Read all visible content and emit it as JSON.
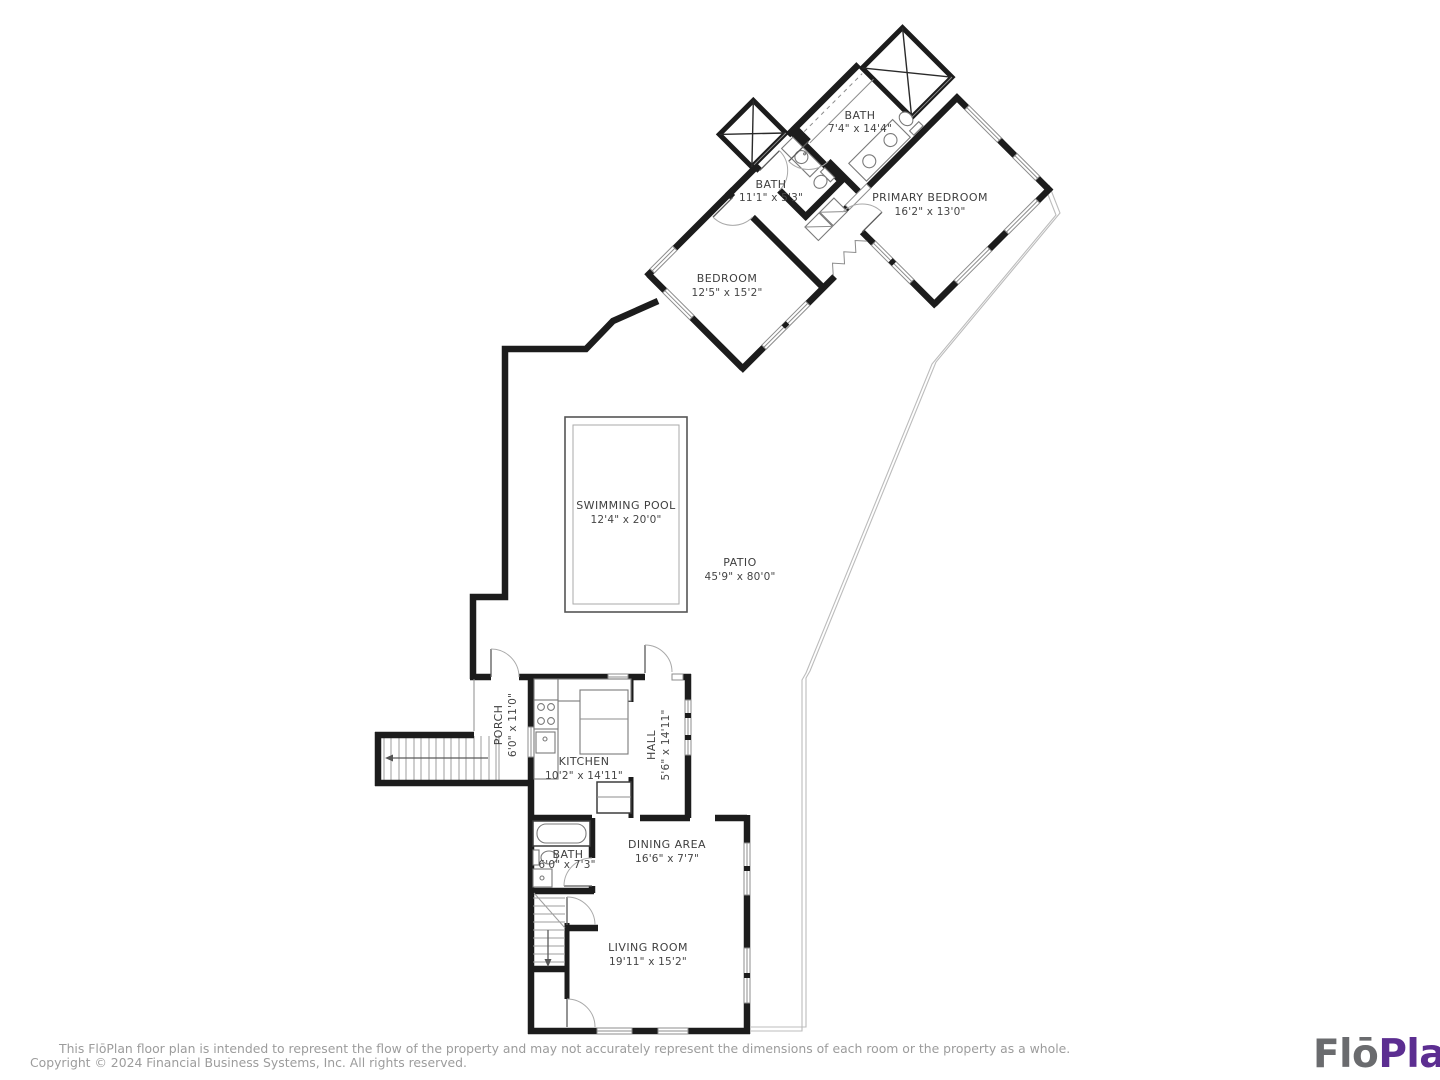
{
  "plan": {
    "rooms": [
      {
        "key": "primary_bedroom",
        "name": "PRIMARY BEDROOM",
        "dims": "16'2\" x 13'0\""
      },
      {
        "key": "bedroom",
        "name": "BEDROOM",
        "dims": "12'5\" x 15'2\""
      },
      {
        "key": "bath_primary",
        "name": "BATH",
        "dims": "7'4\" x 14'4\""
      },
      {
        "key": "bath_upper_hall",
        "name": "BATH",
        "dims": "11'1\" x 5'3\""
      },
      {
        "key": "swimming_pool",
        "name": "SWIMMING POOL",
        "dims": "12'4\" x 20'0\""
      },
      {
        "key": "patio",
        "name": "PATIO",
        "dims": "45'9\" x 80'0\""
      },
      {
        "key": "porch",
        "name": "PORCH",
        "dims": "6'0\" x 11'0\""
      },
      {
        "key": "kitchen",
        "name": "KITCHEN",
        "dims": "10'2\" x 14'11\""
      },
      {
        "key": "hall",
        "name": "HALL",
        "dims": "5'6\" x 14'11\""
      },
      {
        "key": "dining_area",
        "name": "DINING AREA",
        "dims": "16'6\" x 7'7\""
      },
      {
        "key": "bath_lower",
        "name": "BATH",
        "dims": "6'0\" x 7'3\""
      },
      {
        "key": "living_room",
        "name": "LIVING ROOM",
        "dims": "19'11\" x 15'2\""
      }
    ]
  },
  "footer": {
    "disclaimer": "This FlōPlan floor plan is intended to represent the flow of the property and may not accurately represent the dimensions of each room or the property as a whole.",
    "copyright": "Copyright © 2024 Financial Business Systems, Inc. All rights reserved."
  },
  "logo": {
    "flo": "Flō",
    "plan": "Plan",
    "flo_color": "#6a6b6e",
    "plan_color": "#5c2e91"
  }
}
